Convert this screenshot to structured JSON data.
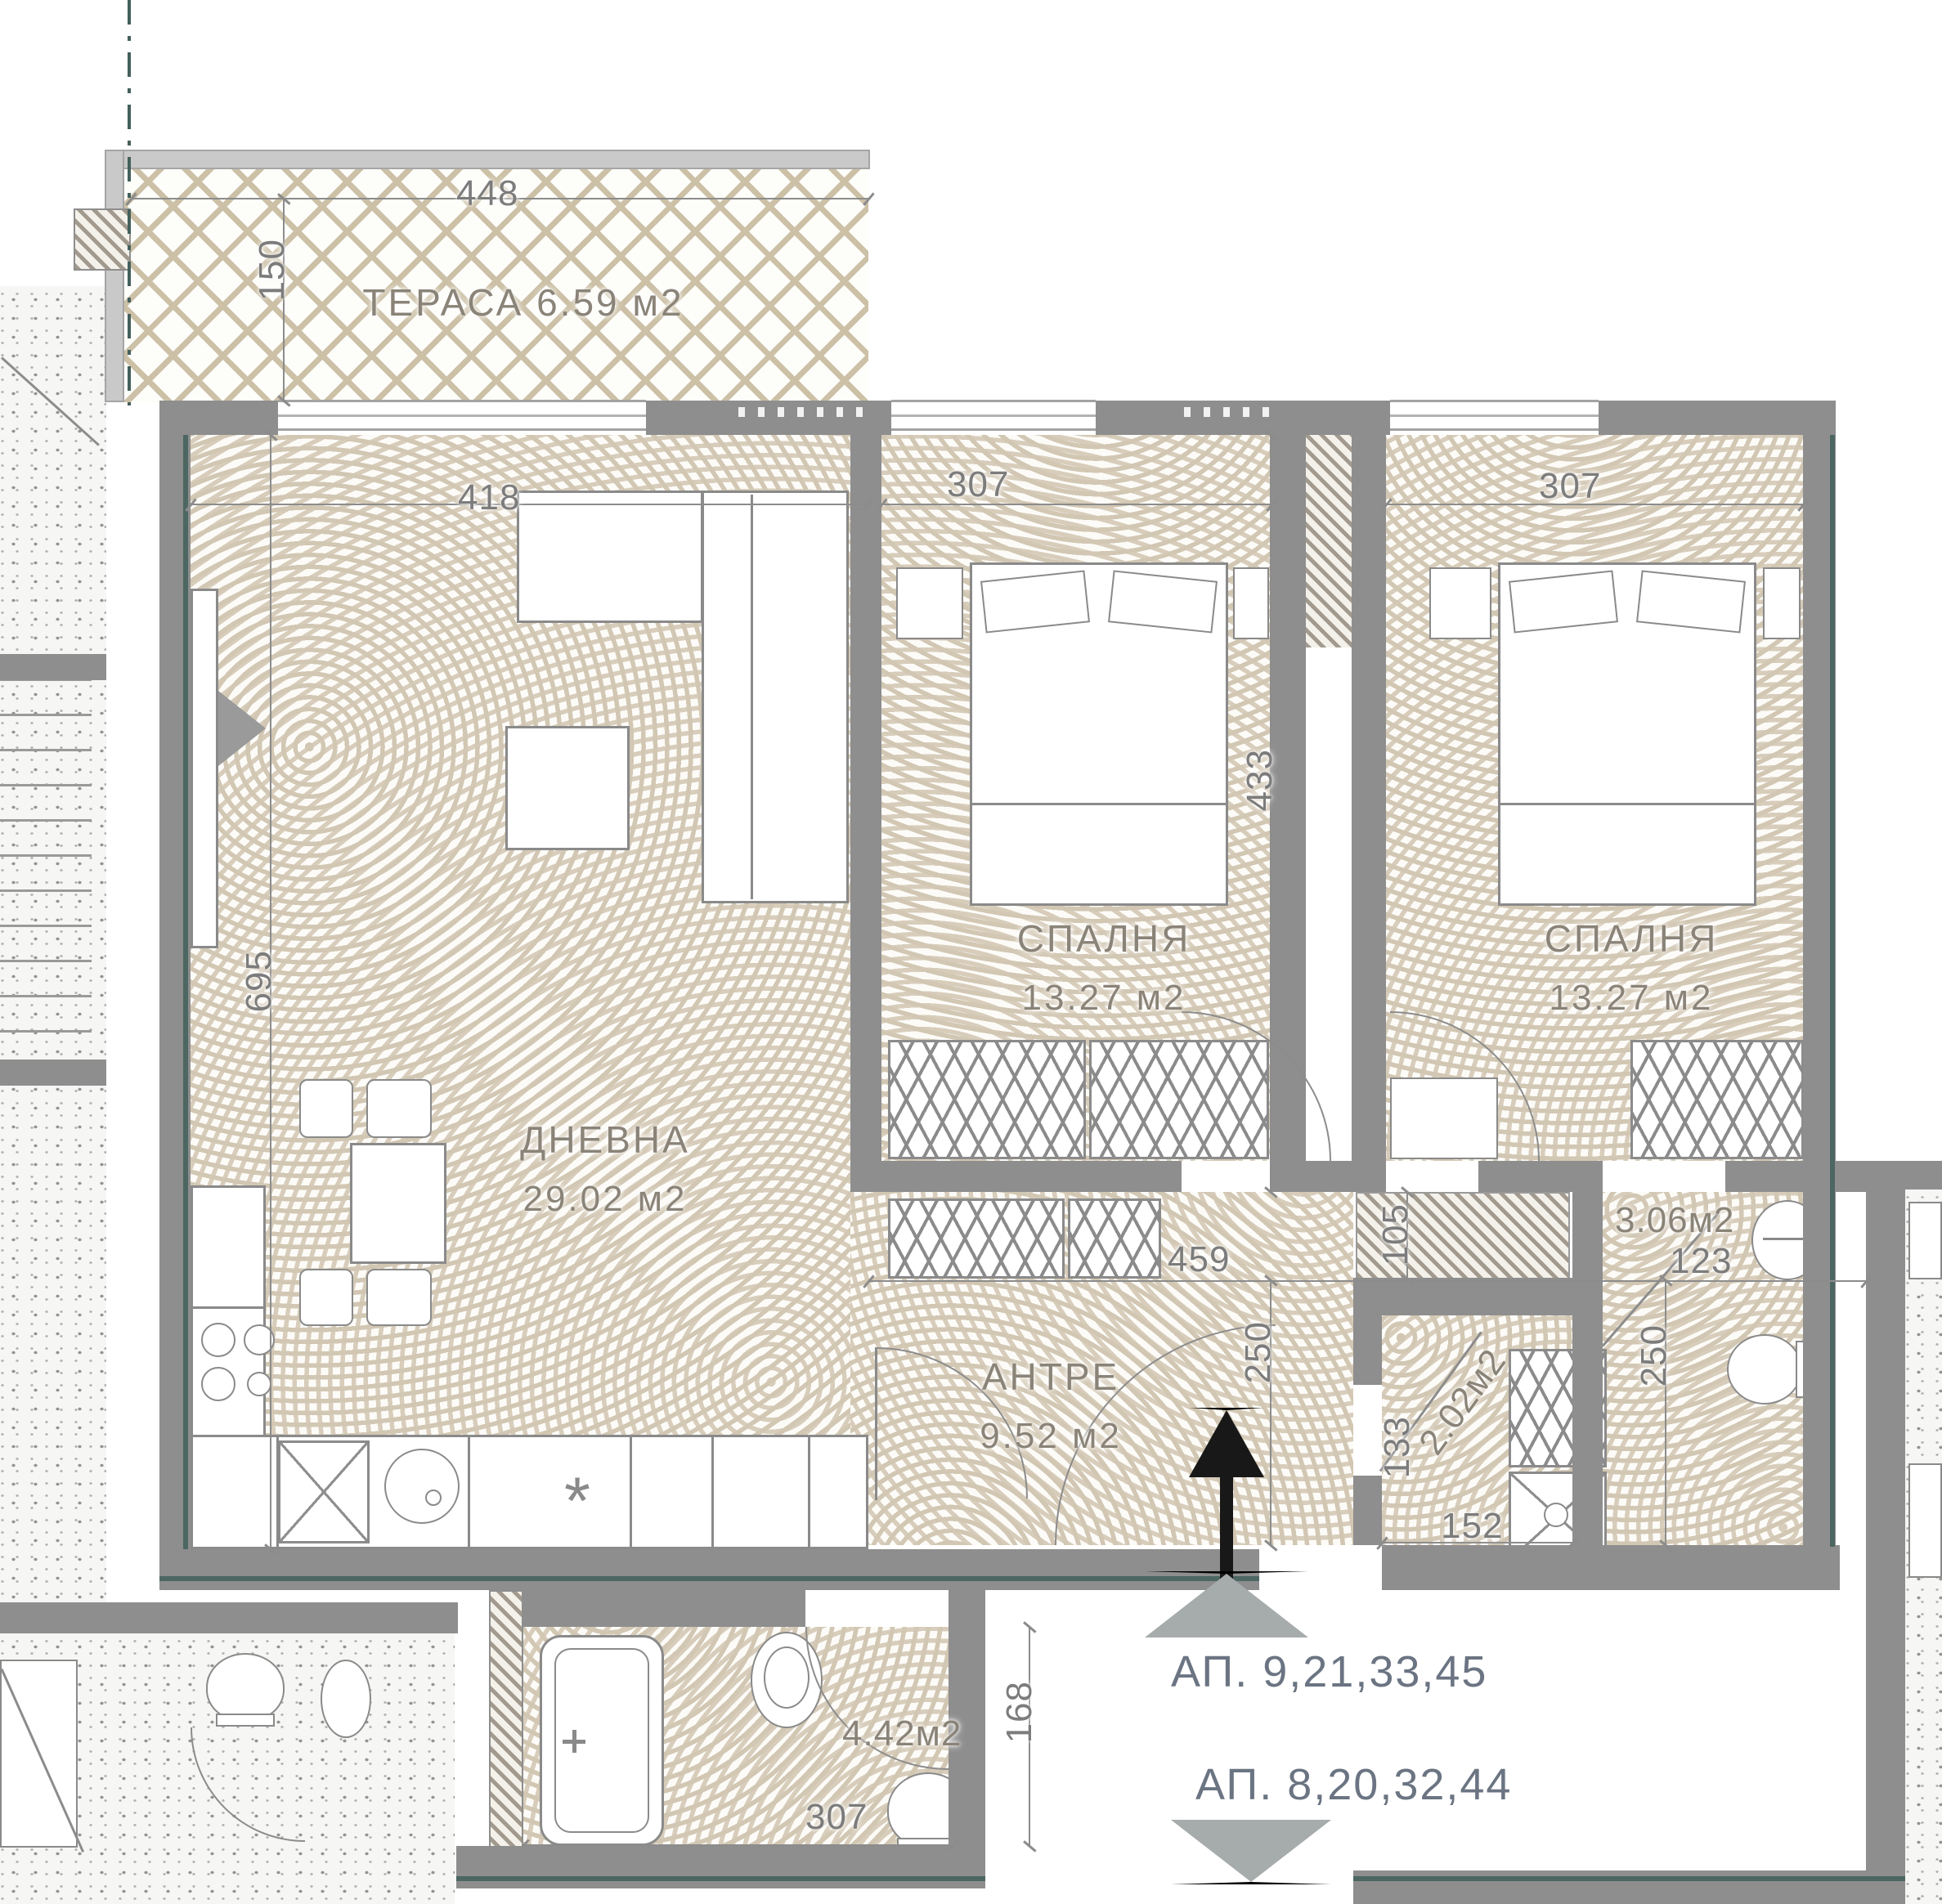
{
  "plan_title": "apartment-floor-plan",
  "colors": {
    "wall": "#8e8e8e",
    "accent_teal": "#4c6662",
    "floor_wave": "#d2c7b3",
    "lattice": "#ccc0a6",
    "dim_text": "#7c7c7c",
    "room_label": "#8a8378",
    "apt_label": "#6b7482",
    "arrow_black": "#181818",
    "triangle_gray": "#a6abab"
  },
  "labels": {
    "terrace": "ТЕРАСА  6.59 м2",
    "living_name": "ДНЕВНА",
    "living_area": "29.02 м2",
    "bedroom1_name": "СПАЛНЯ",
    "bedroom1_area": "13.27 м2",
    "bedroom2_name": "СПАЛНЯ",
    "bedroom2_area": "13.27 м2",
    "hall_name": "АНТРЕ",
    "hall_area": "9.52 м2",
    "bath_area": "4.42м2",
    "wc_area": "3.06м2",
    "closet_area": "2.02м2",
    "kitchen_asterisk": "*"
  },
  "dims": {
    "terrace_w": "448",
    "terrace_d": "150",
    "living_w": "418",
    "living_h": "695",
    "bed1_w": "307",
    "bed2_w": "307",
    "shaft_h": "433",
    "hall_w": "459",
    "hall_d": "250",
    "duct_w": "105",
    "wc_w": "123",
    "wc_d": "250",
    "closet_h": "133",
    "closet_w": "152",
    "bath_d": "168",
    "bath_w": "307"
  },
  "apartments": {
    "line1": "АП. 9,21,33,45",
    "line2": "АП. 8,20,32,44"
  }
}
